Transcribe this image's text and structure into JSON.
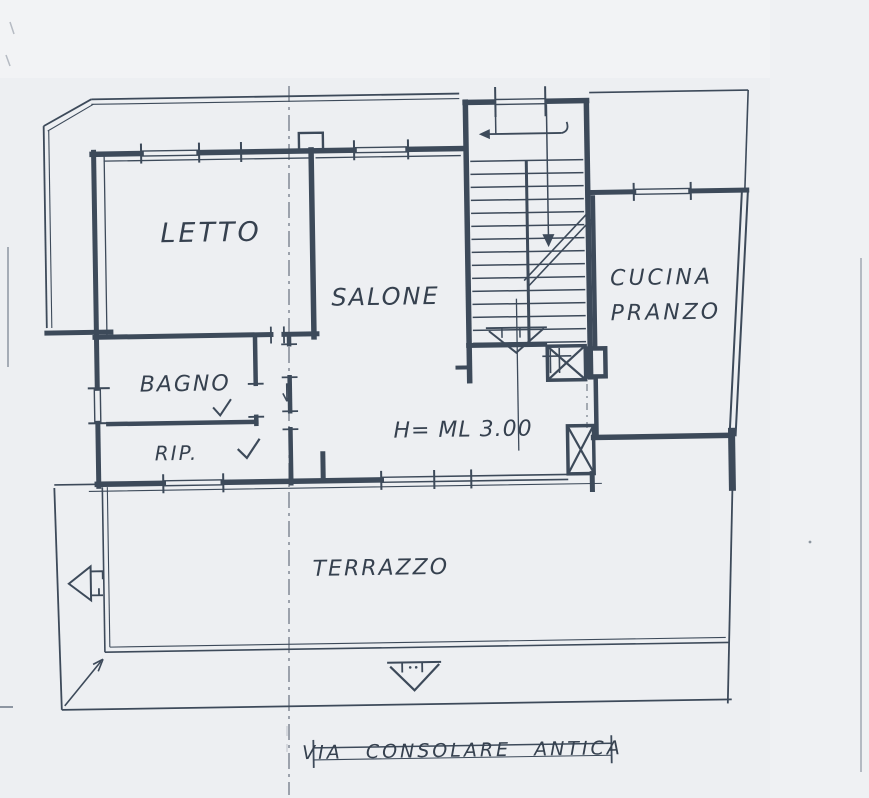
{
  "colors": {
    "paper": "#edeff2",
    "ink": "#3d4a5a",
    "text_ink": "#36414f",
    "centerline": "#5a6472",
    "artifact": "#8d96a2"
  },
  "rooms": {
    "letto": "LETTO",
    "salone": "SALONE",
    "bagno": "BAGNO",
    "rip": "RIP.",
    "cucina_line1": "CUCINA",
    "cucina_line2": "PRANZO",
    "terrazzo": "TERRAZZO"
  },
  "annotations": {
    "ceiling_height": "H= ML 3.00",
    "street": "VIA CONSOLARE ANTICA"
  },
  "icons": {
    "staircase": "staircase-with-up-arrows",
    "shaft_upper": "x-crossed-shaft",
    "shaft_lower": "x-crossed-shaft",
    "terrace_arrow": "left-arrow",
    "entrance_arrow": "down-arrow",
    "corner_arrow": "diagonal-arrow",
    "door_swing_bagno": "check-swing-mark",
    "door_swing_rip": "check-swing-mark"
  }
}
